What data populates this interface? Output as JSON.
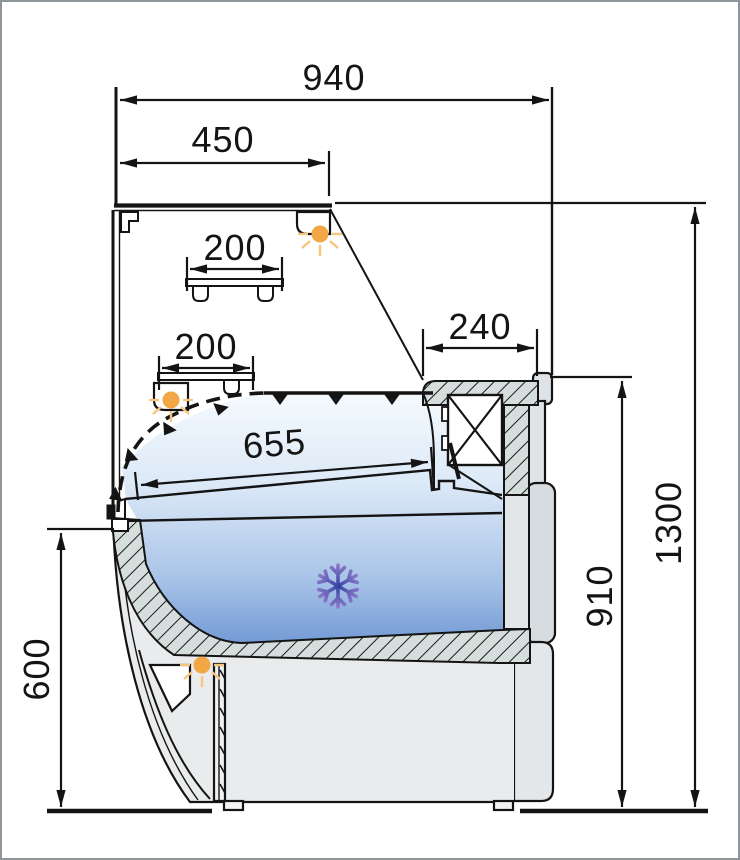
{
  "diagram": {
    "kind": "refrigerated-display-counter-cross-section",
    "dimensions": {
      "total_width": "940",
      "canopy_width": "450",
      "upper_shelf_depth": "200",
      "lower_shelf_depth": "200",
      "rear_top_depth": "240",
      "display_deck_depth": "655",
      "total_height": "1300",
      "rear_worktop_height": "910",
      "front_height": "600"
    },
    "colors": {
      "line": "#141414",
      "accent_light": "#F2A644",
      "light_rays": "#F6C580",
      "snowflake_top": "#8A78C8",
      "snowflake_bottom": "#31439F",
      "zone_top": "#F3F8FD",
      "zone_bottom": "#6E97D3",
      "hatch_fill": "#D5DEDD",
      "body_fill": "#E9EBEC"
    },
    "icons": {
      "lamp": "light-icon",
      "cold_zone": "snowflake-icon"
    }
  }
}
